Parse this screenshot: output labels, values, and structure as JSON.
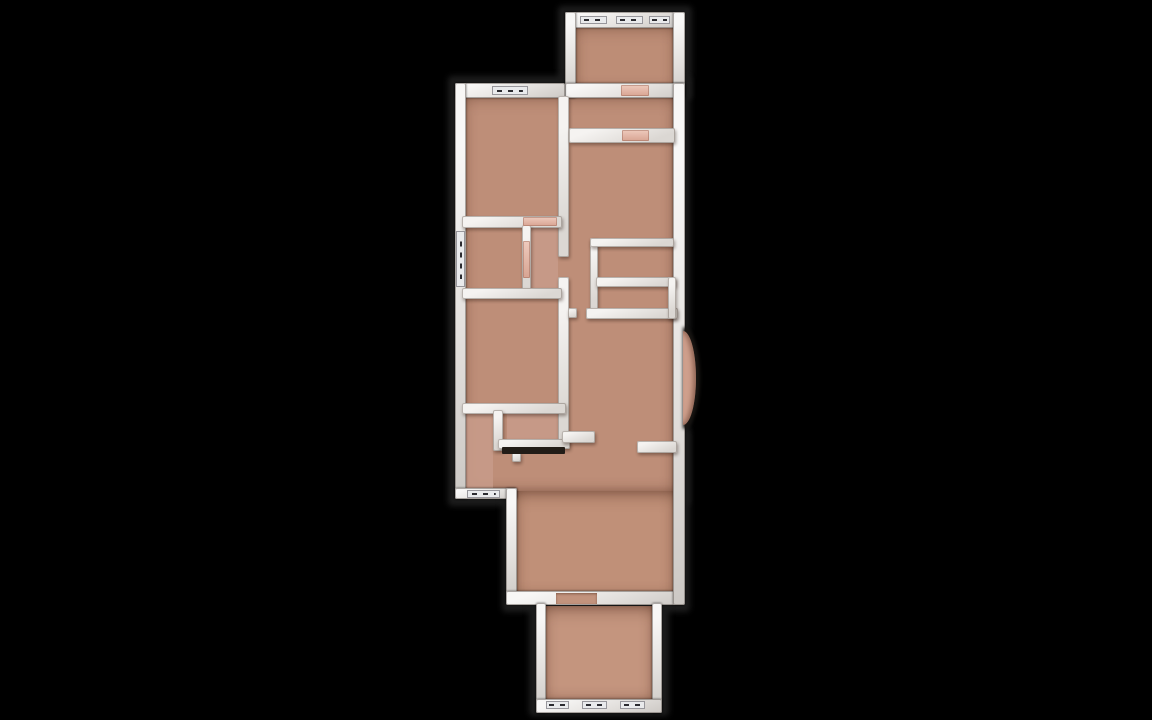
{
  "scene": {
    "background_color": "#000000",
    "description": "3D top-down rendered floor plan of a narrow multi-room apartment on a black background"
  },
  "palette": {
    "floor_main": "#be8e78",
    "floor_top_room": "#bd8d76",
    "floor_lower_hall": "#c09078",
    "floor_bottom_room": "#c4957e",
    "floor_tint_pink": "#c79a88",
    "wall_white": "#efedeb",
    "door_pink": "#e2b6a7",
    "bay_pink": "#cf9f8c",
    "exterior_outline": "#1c1c1c"
  },
  "floor_plan": {
    "elements": [
      {
        "name": "silhouette-top-room",
        "type": "silhouette",
        "x": 558,
        "y": 6,
        "w": 134,
        "h": 94
      },
      {
        "name": "silhouette-main-upper",
        "type": "silhouette",
        "x": 448,
        "y": 76,
        "w": 242,
        "h": 430
      },
      {
        "name": "silhouette-main-lower",
        "type": "silhouette",
        "x": 502,
        "y": 430,
        "w": 188,
        "h": 182
      },
      {
        "name": "silhouette-bottom-room",
        "type": "silhouette",
        "x": 529,
        "y": 594,
        "w": 140,
        "h": 122
      },
      {
        "name": "floor-top-room",
        "type": "floor",
        "x": 574,
        "y": 24,
        "w": 102,
        "h": 66,
        "color": "#bd8d76"
      },
      {
        "name": "floor-main-upper",
        "type": "floor",
        "x": 463,
        "y": 94,
        "w": 212,
        "h": 397,
        "color": "#be8e78"
      },
      {
        "name": "floor-main-lower-hall",
        "type": "floor",
        "x": 515,
        "y": 491,
        "w": 160,
        "h": 104,
        "color": "#c09078"
      },
      {
        "name": "floor-bottom-room",
        "type": "floor",
        "x": 544,
        "y": 606,
        "w": 110,
        "h": 94,
        "color": "#c4957e"
      },
      {
        "name": "floor-tint-vestibule",
        "type": "tint",
        "x": 531,
        "y": 226,
        "w": 27,
        "h": 62,
        "color": "#c79a88"
      },
      {
        "name": "floor-tint-closet",
        "type": "tint",
        "x": 507,
        "y": 413,
        "w": 53,
        "h": 27,
        "color": "#c79a88"
      },
      {
        "name": "floor-tint-bath-strip",
        "type": "tint",
        "x": 465,
        "y": 413,
        "w": 28,
        "h": 76,
        "color": "#c79a88"
      },
      {
        "name": "outer-wall-top-room-top",
        "type": "outer-wall",
        "x": 565,
        "y": 12,
        "w": 112,
        "h": 16
      },
      {
        "name": "outer-wall-top-room-left",
        "type": "outer-wall",
        "x": 565,
        "y": 12,
        "w": 11,
        "h": 86
      },
      {
        "name": "outer-wall-top-room-right",
        "type": "outer-wall",
        "x": 673,
        "y": 12,
        "w": 12,
        "h": 86
      },
      {
        "name": "outer-wall-top-room-bottom",
        "type": "outer-wall",
        "x": 565,
        "y": 83,
        "w": 120,
        "h": 15
      },
      {
        "name": "outer-wall-main-top",
        "type": "outer-wall",
        "x": 455,
        "y": 83,
        "w": 110,
        "h": 15
      },
      {
        "name": "outer-wall-main-left",
        "type": "outer-wall",
        "x": 455,
        "y": 83,
        "w": 11,
        "h": 416
      },
      {
        "name": "outer-wall-main-bottom-left",
        "type": "outer-wall",
        "x": 455,
        "y": 488,
        "w": 62,
        "h": 11
      },
      {
        "name": "outer-wall-step-vertical",
        "type": "outer-wall",
        "x": 506,
        "y": 488,
        "w": 11,
        "h": 115
      },
      {
        "name": "outer-wall-main-bottom",
        "type": "outer-wall",
        "x": 506,
        "y": 591,
        "w": 178,
        "h": 14
      },
      {
        "name": "outer-wall-main-right",
        "type": "outer-wall",
        "x": 673,
        "y": 83,
        "w": 12,
        "h": 522
      },
      {
        "name": "outer-wall-bottom-room-left",
        "type": "outer-wall",
        "x": 536,
        "y": 603,
        "w": 10,
        "h": 110
      },
      {
        "name": "outer-wall-bottom-room-right",
        "type": "outer-wall",
        "x": 652,
        "y": 603,
        "w": 10,
        "h": 110
      },
      {
        "name": "outer-wall-bottom-room-bottom",
        "type": "outer-wall",
        "x": 536,
        "y": 699,
        "w": 126,
        "h": 14
      },
      {
        "name": "inner-wall-spine-upper",
        "type": "inner-wall",
        "x": 558,
        "y": 96,
        "w": 11,
        "h": 161
      },
      {
        "name": "inner-wall-spine-lower",
        "type": "inner-wall",
        "x": 558,
        "y": 277,
        "w": 11,
        "h": 168
      },
      {
        "name": "inner-wall-hall-top",
        "type": "inner-wall",
        "x": 569,
        "y": 128,
        "w": 106,
        "h": 15
      },
      {
        "name": "inner-wall-bedroom-bottom",
        "type": "inner-wall",
        "x": 462,
        "y": 216,
        "w": 100,
        "h": 12
      },
      {
        "name": "inner-wall-vestibule-divider",
        "type": "inner-wall",
        "x": 522,
        "y": 225,
        "w": 9,
        "h": 67
      },
      {
        "name": "inner-wall-vestibule-bottom",
        "type": "inner-wall",
        "x": 462,
        "y": 288,
        "w": 100,
        "h": 11
      },
      {
        "name": "inner-wall-closet-left",
        "type": "inner-wall",
        "x": 590,
        "y": 238,
        "w": 8,
        "h": 77
      },
      {
        "name": "inner-wall-closet-top",
        "type": "inner-wall",
        "x": 590,
        "y": 238,
        "w": 84,
        "h": 9
      },
      {
        "name": "inner-wall-closet-mid",
        "type": "inner-wall",
        "x": 596,
        "y": 277,
        "w": 80,
        "h": 10
      },
      {
        "name": "inner-wall-closet-bottom",
        "type": "inner-wall",
        "x": 586,
        "y": 308,
        "w": 92,
        "h": 11
      },
      {
        "name": "inner-wall-closet-right",
        "type": "inner-wall",
        "x": 668,
        "y": 277,
        "w": 8,
        "h": 42
      },
      {
        "name": "inner-wall-spine-nub",
        "type": "inner-wall",
        "x": 568,
        "y": 308,
        "w": 9,
        "h": 10
      },
      {
        "name": "inner-wall-midroom-bottom",
        "type": "inner-wall",
        "x": 462,
        "y": 403,
        "w": 104,
        "h": 11
      },
      {
        "name": "inner-wall-bath-divider",
        "type": "inner-wall",
        "x": 493,
        "y": 410,
        "w": 10,
        "h": 41
      },
      {
        "name": "inner-wall-bath-bottom",
        "type": "inner-wall",
        "x": 498,
        "y": 439,
        "w": 72,
        "h": 10
      },
      {
        "name": "inner-wall-corner-piece",
        "type": "inner-wall",
        "x": 562,
        "y": 431,
        "w": 33,
        "h": 12
      },
      {
        "name": "inner-wall-hall-right",
        "type": "inner-wall",
        "x": 637,
        "y": 441,
        "w": 40,
        "h": 12
      },
      {
        "name": "inner-wall-bath-stub",
        "type": "inner-wall",
        "x": 512,
        "y": 452,
        "w": 9,
        "h": 10
      },
      {
        "name": "counter-dark-strip",
        "type": "dark-strip",
        "x": 502,
        "y": 447,
        "w": 63,
        "h": 7
      },
      {
        "name": "window-top-room-1",
        "type": "window",
        "x": 580,
        "y": 16,
        "w": 27,
        "h": 8
      },
      {
        "name": "window-top-room-2",
        "type": "window",
        "x": 616,
        "y": 16,
        "w": 27,
        "h": 8
      },
      {
        "name": "window-top-room-3",
        "type": "window",
        "x": 649,
        "y": 16,
        "w": 21,
        "h": 8
      },
      {
        "name": "window-bedroom-top",
        "type": "window",
        "x": 492,
        "y": 86,
        "w": 36,
        "h": 9
      },
      {
        "name": "window-left-wall",
        "type": "window",
        "x": 456,
        "y": 231,
        "w": 9,
        "h": 56
      },
      {
        "name": "window-bath-bottom",
        "type": "window",
        "x": 467,
        "y": 490,
        "w": 33,
        "h": 8
      },
      {
        "name": "window-bottom-room-1",
        "type": "window",
        "x": 546,
        "y": 701,
        "w": 23,
        "h": 8
      },
      {
        "name": "window-bottom-room-2",
        "type": "window",
        "x": 582,
        "y": 701,
        "w": 25,
        "h": 8
      },
      {
        "name": "window-bottom-room-3",
        "type": "window",
        "x": 620,
        "y": 701,
        "w": 25,
        "h": 8
      },
      {
        "name": "door-top-room",
        "type": "door",
        "x": 621,
        "y": 85,
        "w": 28,
        "h": 11
      },
      {
        "name": "door-hall-top",
        "type": "door",
        "x": 622,
        "y": 130,
        "w": 27,
        "h": 11
      },
      {
        "name": "door-bedroom-leaf",
        "type": "door",
        "x": 523,
        "y": 217,
        "w": 34,
        "h": 9
      },
      {
        "name": "door-vestibule",
        "type": "door",
        "x": 523,
        "y": 241,
        "w": 7,
        "h": 37
      },
      {
        "name": "opening-bottom-room",
        "type": "opening",
        "x": 556,
        "y": 593,
        "w": 41,
        "h": 11
      },
      {
        "name": "bay-window-outline",
        "type": "bay-outline",
        "x": 683,
        "y": 327,
        "w": 17,
        "h": 102
      },
      {
        "name": "bay-window-floor",
        "type": "bay",
        "x": 683,
        "y": 331,
        "w": 13,
        "h": 94,
        "color": "#cf9f8c"
      }
    ]
  }
}
